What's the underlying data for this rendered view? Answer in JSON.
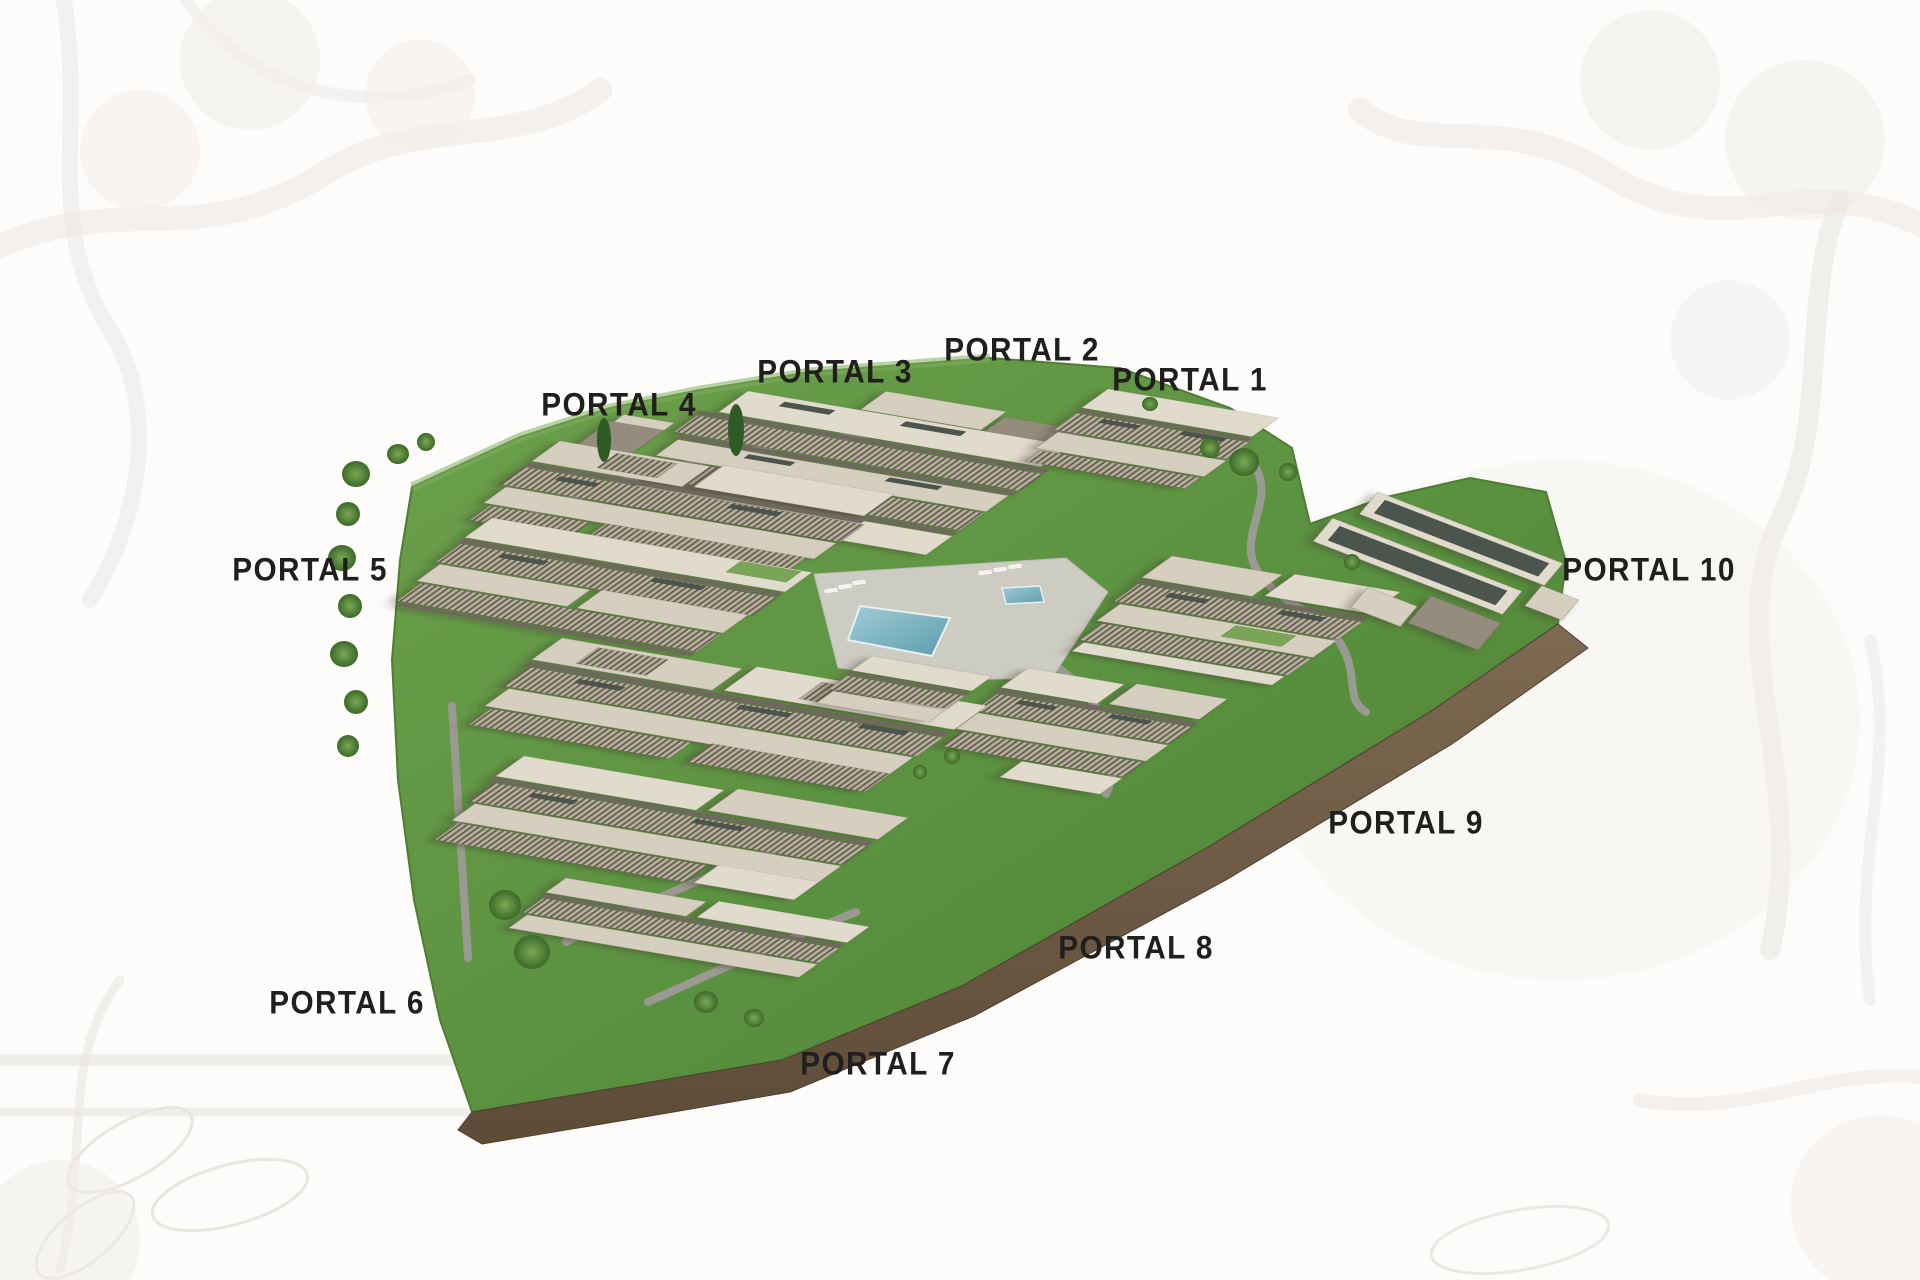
{
  "image": {
    "type": "aerial-3d-masterplan-render",
    "description": "Isometric aerial render of a terraced residential complex with ten labelled portals, central swimming pool, lawns, trees and a perimeter retaining wall, on a white background with faint botanical engravings"
  },
  "portals": [
    {
      "id": 1,
      "label": "PORTAL 1"
    },
    {
      "id": 2,
      "label": "PORTAL 2"
    },
    {
      "id": 3,
      "label": "PORTAL 3"
    },
    {
      "id": 4,
      "label": "PORTAL 4"
    },
    {
      "id": 5,
      "label": "PORTAL 5"
    },
    {
      "id": 6,
      "label": "PORTAL 6"
    },
    {
      "id": 7,
      "label": "PORTAL 7"
    },
    {
      "id": 8,
      "label": "PORTAL 8"
    },
    {
      "id": 9,
      "label": "PORTAL 9"
    },
    {
      "id": 10,
      "label": "PORTAL 10"
    }
  ],
  "colors": {
    "label_text": "#211f1d",
    "lawn_green": "#5f9440",
    "lawn_dark": "#4a7d2e",
    "building_roof": "#d6cfbf",
    "building_roof_pale": "#e1dbcd",
    "building_louver_dark": "#5f5a49",
    "building_wall_dark": "#948c7b",
    "glass": "#4c544e",
    "pool_water": "#74aebc",
    "pool_deck": "#ccccc3",
    "walkway": "#9b9a92",
    "retaining_wall": "#6f5b45",
    "tree_green": "#3f6d2a",
    "engraving": "#d9d2c9"
  }
}
